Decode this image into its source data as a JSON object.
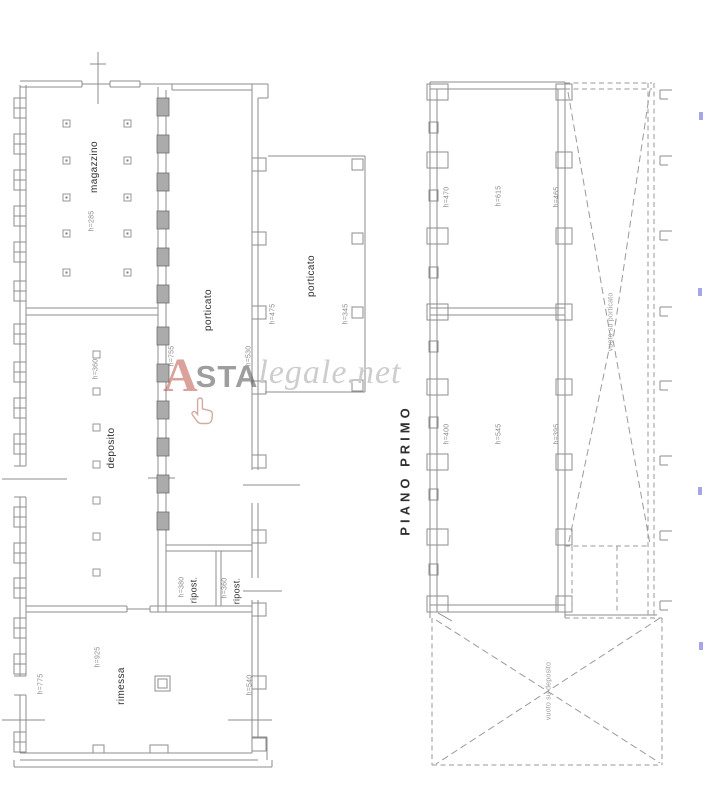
{
  "watermark": {
    "logo_letter": "A",
    "brand_bold": "STA",
    "brand_light": "legale.net"
  },
  "ground_floor": {
    "magazzino_label": "magazzino",
    "magazzino_height": "h=285",
    "deposito_label": "deposito",
    "deposito_height": "h=360",
    "porticato_label": "porticato",
    "porticato_height_left": "h=755",
    "porticato_height_right": "h=530",
    "annex_porticato_label": "porticato",
    "annex_height_left": "h=475",
    "annex_height_right": "h=345",
    "ripost1_label": "ripost.",
    "ripost1_height": "h=380",
    "ripost2_label": "ripost.",
    "ripost2_height": "h=360",
    "rimessa_label": "rimessa",
    "rimessa_height": "h=925",
    "rimessa_height_left": "h=775",
    "rimessa_height_right": "h=540"
  },
  "first_floor": {
    "title": "PIANO PRIMO",
    "top_room_height_left": "h=470",
    "top_room_height_center": "h=615",
    "top_room_height_right": "h=465",
    "bottom_room_height_left": "h=400",
    "bottom_room_height_center": "h=545",
    "bottom_room_height_right": "h=395",
    "void_right_label": "vuoto su porticato",
    "void_bottom_label": "vuoto su deposito"
  },
  "colors": {
    "plan_line": "#8d8d8d",
    "watermark_red": "#b9463a",
    "watermark_gray": "#4f4f4f",
    "watermark_light_gray": "#cbcbcb",
    "edge_mark_blue": "#5b5bd6"
  }
}
